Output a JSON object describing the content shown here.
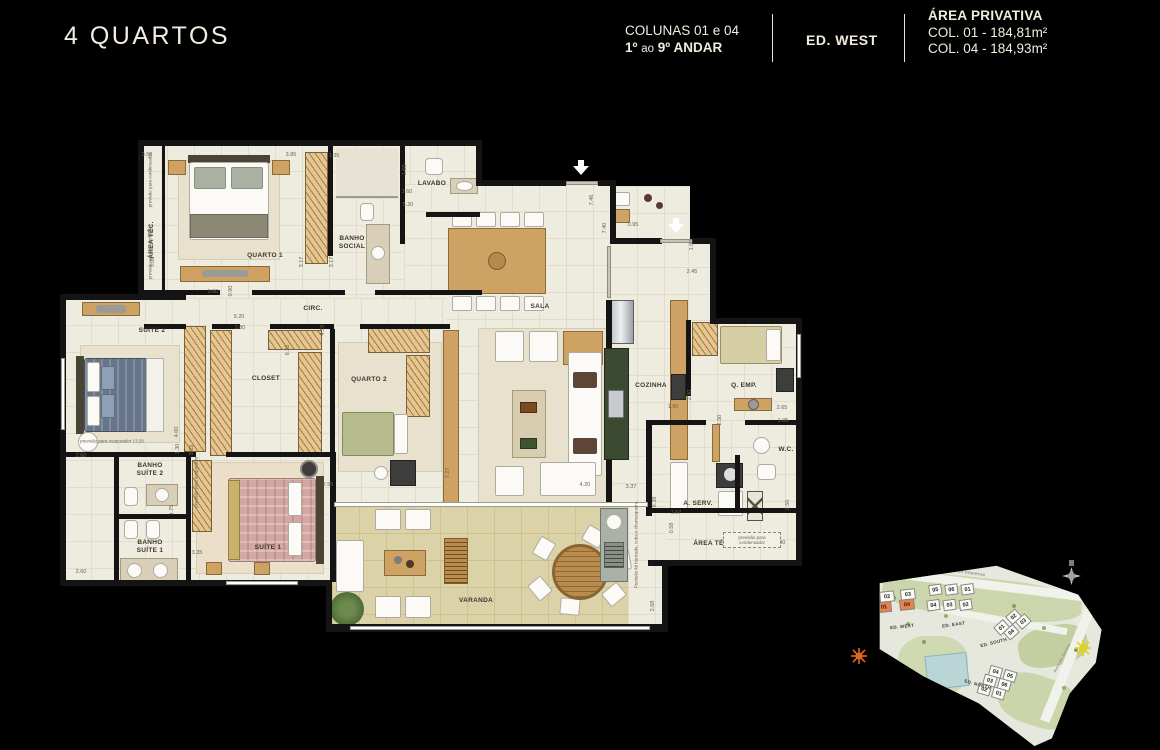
{
  "header": {
    "title": "4 QUARTOS",
    "columns_label": "COLUNAS 01 e 04",
    "floors_pre": "1º",
    "floors_mid": "ao",
    "floors_post": "9º ANDAR",
    "building_label": "ED. WEST",
    "area_title": "ÁREA PRIVATIVA",
    "area_col01": "COL. 01 - 184,81m²",
    "area_col04": "COL. 04 - 184,93m²"
  },
  "colors": {
    "accent_orange": "#e8824e",
    "cream_text": "#f2ecdf",
    "wall": "#141414"
  },
  "icons": {
    "entrance_arrow": "white down-arrow at unit entries",
    "compass": "compass-rose",
    "sun_west": "orange sun (sunset side)",
    "sun_east": "yellow sun (sunrise side)"
  },
  "plan": {
    "rooms": {
      "area_tec_left": "ÁREA TÉC.",
      "quarto1": "QUARTO 1",
      "banho_social": "BANHO\nSOCIAL",
      "lavabo": "LAVABO",
      "circ": "CIRC.",
      "sala": "SALA",
      "cozinha": "COZINHA",
      "q_emp": "Q. EMP.",
      "wc": "W.C.",
      "a_serv": "A. SERV.",
      "area_tec_right": "ÁREA TÉC.",
      "suite2": "SUÍTE 2",
      "closet": "CLOSET",
      "quarto2": "QUARTO 2",
      "banho_suite2": "BANHO\nSUÍTE 2",
      "banho_suite1": "BANHO\nSUÍTE 1",
      "suite1": "SUÍTE 1",
      "varanda": "VARANDA"
    },
    "dims": [
      {
        "v": "0.58",
        "x": 147,
        "y": 155
      },
      {
        "v": "3.05",
        "x": 153,
        "y": 262,
        "r": 1
      },
      {
        "v": "3.80",
        "x": 213,
        "y": 292
      },
      {
        "v": "0.90",
        "x": 231,
        "y": 291,
        "r": 1
      },
      {
        "v": "3.85",
        "x": 291,
        "y": 155
      },
      {
        "v": "1.35",
        "x": 334,
        "y": 156
      },
      {
        "v": "1.68",
        "x": 405,
        "y": 170,
        "r": 1
      },
      {
        "v": "1.60",
        "x": 407,
        "y": 192
      },
      {
        "v": "5.20",
        "x": 408,
        "y": 205
      },
      {
        "v": "3.17",
        "x": 302,
        "y": 262,
        "r": 1
      },
      {
        "v": "3.17",
        "x": 332,
        "y": 262,
        "r": 1
      },
      {
        "v": "7.46",
        "x": 592,
        "y": 200,
        "r": 1
      },
      {
        "v": "7.40",
        "x": 605,
        "y": 228,
        "r": 1
      },
      {
        "v": "0.95",
        "x": 633,
        "y": 225
      },
      {
        "v": "1.80",
        "x": 692,
        "y": 245,
        "r": 1
      },
      {
        "v": "2.45",
        "x": 692,
        "y": 272
      },
      {
        "v": "9.20",
        "x": 239,
        "y": 317
      },
      {
        "v": "2.80",
        "x": 240,
        "y": 328
      },
      {
        "v": "4.15",
        "x": 323,
        "y": 330,
        "r": 1
      },
      {
        "v": "6.35",
        "x": 288,
        "y": 350,
        "r": 1
      },
      {
        "v": "2.55",
        "x": 328,
        "y": 485
      },
      {
        "v": "7.27",
        "x": 448,
        "y": 473,
        "r": 1
      },
      {
        "v": "4.20",
        "x": 585,
        "y": 485
      },
      {
        "v": "3.37",
        "x": 631,
        "y": 487
      },
      {
        "v": "1.95",
        "x": 673,
        "y": 407
      },
      {
        "v": "2.30",
        "x": 690,
        "y": 395,
        "r": 1
      },
      {
        "v": "2.65",
        "x": 782,
        "y": 408
      },
      {
        "v": "1.05",
        "x": 783,
        "y": 421
      },
      {
        "v": "2.50",
        "x": 720,
        "y": 420,
        "r": 1
      },
      {
        "v": "2.50",
        "x": 788,
        "y": 505,
        "r": 1
      },
      {
        "v": "1.67",
        "x": 676,
        "y": 513
      },
      {
        "v": "0.58",
        "x": 672,
        "y": 528,
        "r": 1
      },
      {
        "v": "2.90",
        "x": 780,
        "y": 543
      },
      {
        "v": "6.38",
        "x": 655,
        "y": 502,
        "r": 1
      },
      {
        "v": "2.68",
        "x": 653,
        "y": 606,
        "r": 1
      },
      {
        "v": "2.60",
        "x": 81,
        "y": 456
      },
      {
        "v": "4.00",
        "x": 177,
        "y": 432,
        "r": 1
      },
      {
        "v": "1.30",
        "x": 178,
        "y": 449,
        "r": 1
      },
      {
        "v": "3.25",
        "x": 192,
        "y": 450,
        "r": 1
      },
      {
        "v": "1.75",
        "x": 172,
        "y": 510,
        "r": 1
      },
      {
        "v": "3.35",
        "x": 197,
        "y": 553
      },
      {
        "v": "2.60",
        "x": 81,
        "y": 572
      }
    ],
    "notes": [
      {
        "t": "previsão para condensador",
        "x": 150,
        "y": 180,
        "r": 1
      },
      {
        "t": "previsão para condensador",
        "x": 150,
        "y": 252,
        "r": 1
      },
      {
        "t": "previsão para evaporador | 3.20",
        "x": 112,
        "y": 441
      },
      {
        "t": "previsão para evaporador",
        "x": 196,
        "y": 482,
        "r": 1
      },
      {
        "t": "Previsão kit bancada, cuba e churrasqueira",
        "x": 636,
        "y": 545,
        "r": 1
      },
      {
        "t": "previsão para condensador",
        "x": 752,
        "y": 540,
        "box": 1
      }
    ]
  },
  "sitemap": {
    "street_top": "Rua Frei Jacinto Infantino",
    "street_right_line1": "Avenida",
    "street_right_line2": "Estrela",
    "buildings": {
      "west": {
        "label": "ED. WEST",
        "rows": [
          [
            "02",
            "03"
          ],
          [
            "01",
            "04"
          ]
        ]
      },
      "east": {
        "label": "ED. EAST",
        "rows": [
          [
            "05",
            "06",
            "01"
          ],
          [
            "04",
            "03",
            "02"
          ]
        ]
      },
      "south": {
        "label": "ED. SOUTH",
        "rows": [
          [
            "01",
            "02"
          ],
          [
            "04",
            "03"
          ]
        ]
      },
      "north": {
        "label": "ED. NORTH",
        "rows": [
          [
            "04",
            "05"
          ],
          [
            "03",
            "06"
          ],
          [
            "02",
            "01"
          ]
        ]
      }
    },
    "highlighted_units": [
      "01",
      "04"
    ]
  }
}
